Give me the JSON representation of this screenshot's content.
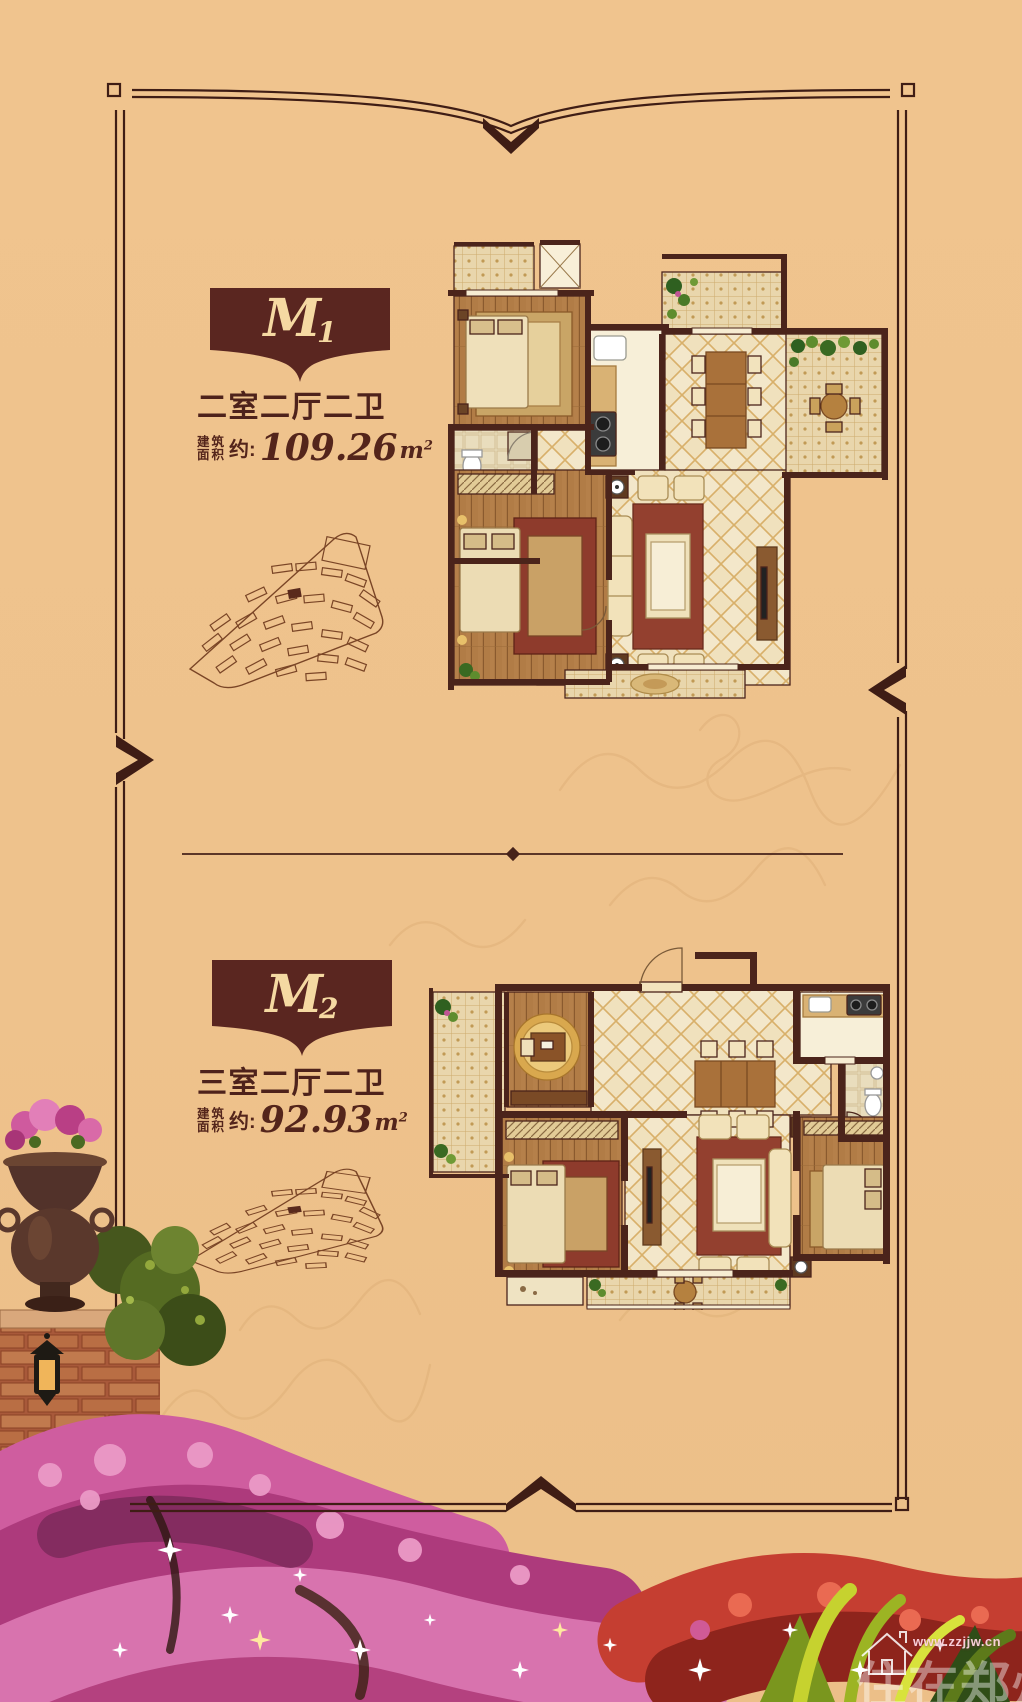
{
  "page": {
    "background_color": "#eec28c",
    "frame_color": "#3f1d15",
    "accent_maroon": "#5a2620",
    "badge_text_color": "#f5d9a2"
  },
  "units": [
    {
      "badge_letter": "M",
      "badge_number": "1",
      "layout_label": "二室二厅二卫",
      "area_prefix_line1": "建筑",
      "area_prefix_line2": "面积",
      "area_approx": "约:",
      "area_value": "109.26",
      "area_unit_base": "m",
      "area_unit_sup": "2"
    },
    {
      "badge_letter": "M",
      "badge_number": "2",
      "layout_label": "三室二厅二卫",
      "area_prefix_line1": "建筑",
      "area_prefix_line2": "面积",
      "area_approx": "约:",
      "area_value": "92.93",
      "area_unit_base": "m",
      "area_unit_sup": "2"
    }
  ],
  "watermark": {
    "url": "www.zzjjw.cn",
    "brand": "住在郑州"
  }
}
